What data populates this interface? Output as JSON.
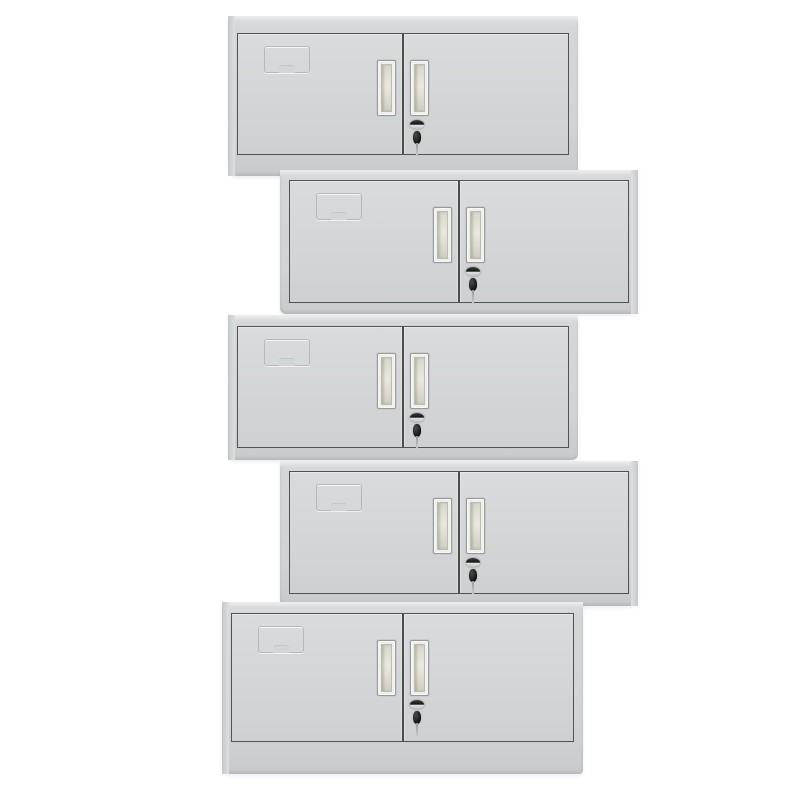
{
  "scene": {
    "description": "Product photo: five light-grey two-door steel office wall cabinets stacked vertically in an alternating zigzag arrangement on a plain white background",
    "background_color": "#ffffff",
    "unit_count": 5
  },
  "colors": {
    "body": "#d3d4d5",
    "body_highlight": "#edeeee",
    "body_shadow": "#c7c8c9",
    "door": "#d4d5d6",
    "door_outline": "#515253",
    "handle_frame": "#98999a",
    "handle_groove": "#e9e9de",
    "lock_dark": "#161616",
    "key_dark": "#101010",
    "key_stem": "#c8c9ca",
    "label_outline": "#b7b8b9"
  },
  "cabinets": [
    {
      "id": "cabinet-1",
      "stack_slot": 1,
      "offset": "left",
      "doors": 2,
      "has_base": false,
      "parts": [
        "label-card-holder",
        "left-door-handle",
        "right-door-handle",
        "lock-keyhole",
        "hanging-key"
      ]
    },
    {
      "id": "cabinet-2",
      "stack_slot": 2,
      "offset": "right",
      "doors": 2,
      "has_base": false,
      "parts": [
        "label-card-holder",
        "left-door-handle",
        "right-door-handle",
        "lock-keyhole",
        "hanging-key"
      ]
    },
    {
      "id": "cabinet-3",
      "stack_slot": 3,
      "offset": "left",
      "doors": 2,
      "has_base": false,
      "parts": [
        "label-card-holder",
        "left-door-handle",
        "right-door-handle",
        "lock-keyhole",
        "hanging-key"
      ]
    },
    {
      "id": "cabinet-4",
      "stack_slot": 4,
      "offset": "right",
      "doors": 2,
      "has_base": false,
      "parts": [
        "label-card-holder",
        "left-door-handle",
        "right-door-handle",
        "lock-keyhole",
        "hanging-key"
      ]
    },
    {
      "id": "cabinet-5",
      "stack_slot": 5,
      "offset": "left",
      "doors": 2,
      "has_base": true,
      "parts": [
        "label-card-holder",
        "left-door-handle",
        "right-door-handle",
        "lock-keyhole",
        "hanging-key"
      ]
    }
  ]
}
